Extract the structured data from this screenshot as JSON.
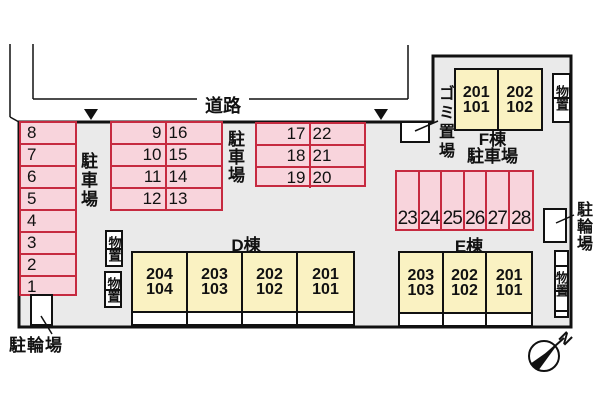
{
  "colors": {
    "site_fill": "#eaeaea",
    "stall_fill": "#f8d4dc",
    "stall_border": "#c62a40",
    "building_fill": "#faf2c2",
    "outline": "#111111"
  },
  "road": {
    "label": "道路"
  },
  "site": {
    "parking_label_left": "駐車場",
    "parking_label_mid": "駐車場",
    "garbage_label": "ゴミ置場",
    "bicycle_label_left": "駐輪場",
    "bicycle_label_right": "駐輪場",
    "storage_label_1": "物置",
    "storage_label_2": "物置",
    "storage_label_f": "物置",
    "storage_label_e": "物置"
  },
  "stalls": {
    "left_column": [
      "8",
      "7",
      "6",
      "5",
      "4",
      "3",
      "2",
      "1"
    ],
    "block_a": [
      [
        "9",
        "16"
      ],
      [
        "10",
        "15"
      ],
      [
        "11",
        "14"
      ],
      [
        "12",
        "13"
      ]
    ],
    "block_b": [
      [
        "17",
        "22"
      ],
      [
        "18",
        "21"
      ],
      [
        "19",
        "20"
      ]
    ],
    "bottom_row": [
      "23",
      "24",
      "25",
      "26",
      "27",
      "28"
    ]
  },
  "buildings": {
    "d": {
      "label": "D棟",
      "units": [
        {
          "top": "204",
          "bottom": "104"
        },
        {
          "top": "203",
          "bottom": "103"
        },
        {
          "top": "202",
          "bottom": "102"
        },
        {
          "top": "201",
          "bottom": "101"
        }
      ]
    },
    "e": {
      "label": "E棟",
      "units": [
        {
          "top": "203",
          "bottom": "103"
        },
        {
          "top": "202",
          "bottom": "102"
        },
        {
          "top": "201",
          "bottom": "101"
        }
      ]
    },
    "f": {
      "label": "F棟",
      "parking_label": "駐車場",
      "units": [
        {
          "top": "201",
          "bottom": "101"
        },
        {
          "top": "202",
          "bottom": "102"
        }
      ]
    }
  },
  "compass": {
    "north_label": "N"
  }
}
